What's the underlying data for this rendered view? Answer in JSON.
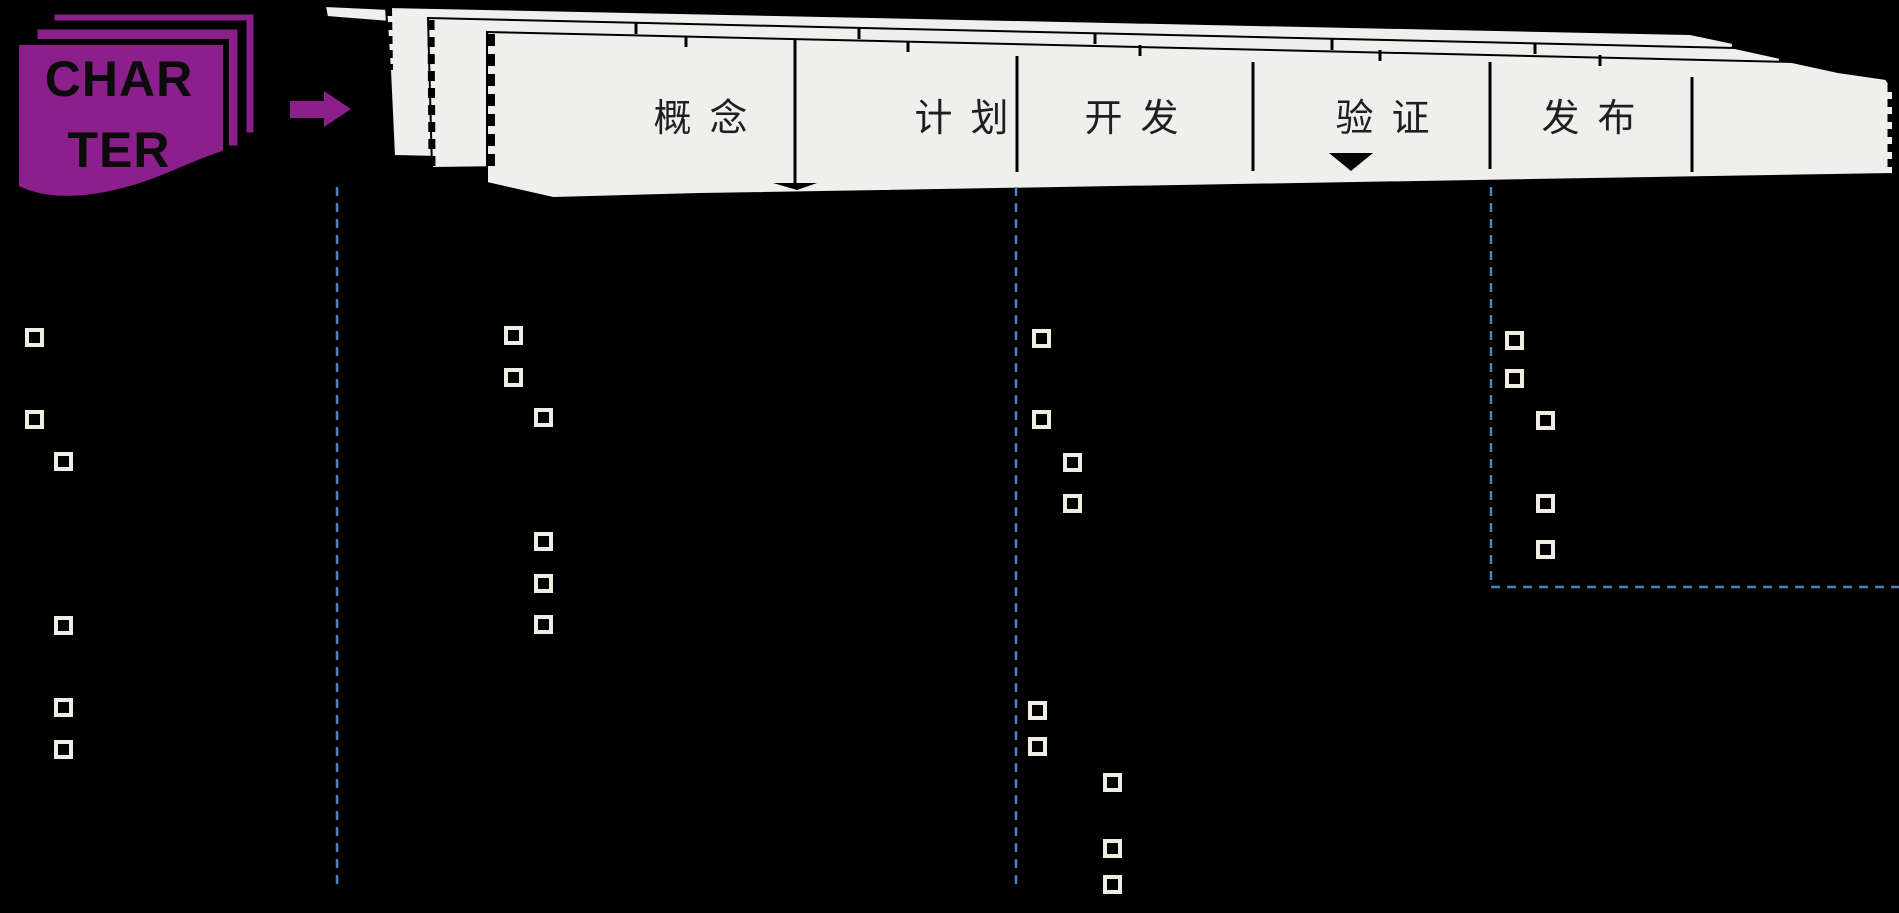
{
  "slide": {
    "background": "#000000"
  },
  "charter": {
    "line1": "CHAR",
    "line2": "TER",
    "fill": "#8b1f8b",
    "text_color": "#0b0b0b"
  },
  "arrow": {
    "fill": "#8b1f8b"
  },
  "banner": {
    "fill": "#efefed",
    "outline": "#000000",
    "label_color": "#1f1f1f",
    "phases": [
      {
        "label": "概 念"
      },
      {
        "label": "计 划"
      },
      {
        "label": "开 发"
      },
      {
        "label": "验 证",
        "current_marker": true
      },
      {
        "label": "发 布"
      }
    ],
    "marker": "black-down-triangle"
  },
  "checkpoint_lines": {
    "color": "#4f81bd",
    "lines": [
      {
        "type": "vertical",
        "x": 337,
        "y1": 187,
        "y2": 885
      },
      {
        "type": "vertical",
        "x": 1016,
        "y1": 187,
        "y2": 885
      },
      {
        "type": "elbow-right",
        "x": 1491,
        "y1": 187,
        "y2": 587,
        "x2": 1899
      }
    ]
  },
  "bullets": {
    "color": "#efece2",
    "columns": [
      {
        "name": "column-1",
        "items": [
          {
            "x": 34,
            "y": 337
          },
          {
            "x": 34,
            "y": 419
          },
          {
            "x": 63,
            "y": 461
          },
          {
            "x": 63,
            "y": 625
          },
          {
            "x": 63,
            "y": 707
          },
          {
            "x": 63,
            "y": 749
          }
        ]
      },
      {
        "name": "column-2",
        "items": [
          {
            "x": 513,
            "y": 335
          },
          {
            "x": 513,
            "y": 377
          },
          {
            "x": 543,
            "y": 417
          },
          {
            "x": 543,
            "y": 541
          },
          {
            "x": 543,
            "y": 583
          },
          {
            "x": 543,
            "y": 624
          }
        ]
      },
      {
        "name": "column-3",
        "items": [
          {
            "x": 1041,
            "y": 338
          },
          {
            "x": 1041,
            "y": 419
          },
          {
            "x": 1072,
            "y": 462
          },
          {
            "x": 1072,
            "y": 503
          },
          {
            "x": 1037,
            "y": 710
          },
          {
            "x": 1037,
            "y": 746
          },
          {
            "x": 1112,
            "y": 782
          },
          {
            "x": 1112,
            "y": 848
          },
          {
            "x": 1112,
            "y": 884
          }
        ]
      },
      {
        "name": "column-4",
        "items": [
          {
            "x": 1514,
            "y": 340
          },
          {
            "x": 1514,
            "y": 378
          },
          {
            "x": 1545,
            "y": 420
          },
          {
            "x": 1545,
            "y": 503
          },
          {
            "x": 1545,
            "y": 549
          }
        ]
      }
    ]
  }
}
